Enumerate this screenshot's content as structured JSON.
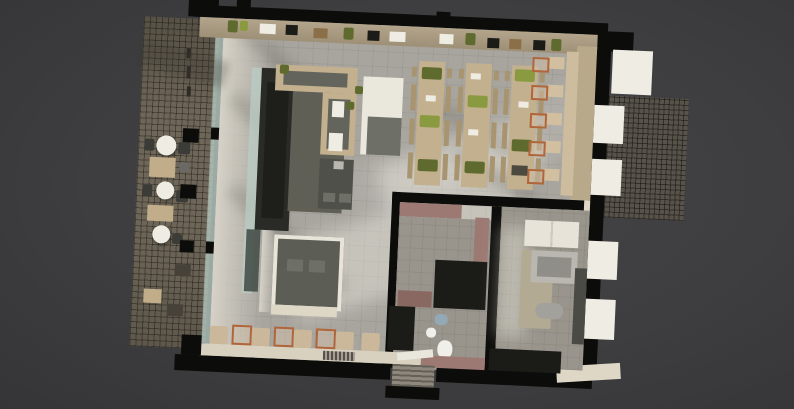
{
  "scene": {
    "caption": "Top-down 3D rendered floor plan of a cafe-restaurant with street terrace, long bar, communal dining tables, banquette window seating, kitchen and restrooms"
  },
  "palette": {
    "wall": "#0c0c0a",
    "sidewalk": "#6e6759",
    "sidewalkDark": "#57524a",
    "floor": "#a8a59f",
    "walkway": "#d6d2c7",
    "cream": "#ded7c6",
    "white": "#efece3",
    "glass": "#b9cec6",
    "barDark": "#2a2b26",
    "barInner": "#1e1f1b",
    "serviceFloor": "#5f5f56",
    "wood": "#c3b08e",
    "woodDark": "#a8946f",
    "counterGray": "#63645b",
    "plant": "#5e6a2e",
    "plantLight": "#8a9a40",
    "banquette": "#b9a98b",
    "orange": "#b0653a",
    "mauve": "#9d7973",
    "mauveDark": "#8a6862",
    "kitchenFloor": "#99958c",
    "matBeige": "#b2aa93",
    "steel": "#b9b7b0",
    "steelDark": "#8f8e88",
    "charcoal": "#1b1b18",
    "pit": "#5c5d55",
    "pitMat": "#6e6f66",
    "fixtureWhite": "#f1efe9",
    "sinkBlue": "#93a9b6",
    "doorMat": "#8f897d",
    "chairDark": "#3b3b37"
  },
  "furniture": {
    "communal_tables": 3,
    "banquette_tables": 5,
    "window_bench_tables": 3,
    "terrace_round_tables": 3,
    "terrace_square_tables": 3,
    "restroom_fixtures": [
      "sink",
      "bidet",
      "toilet"
    ],
    "facade_columns": 3
  }
}
